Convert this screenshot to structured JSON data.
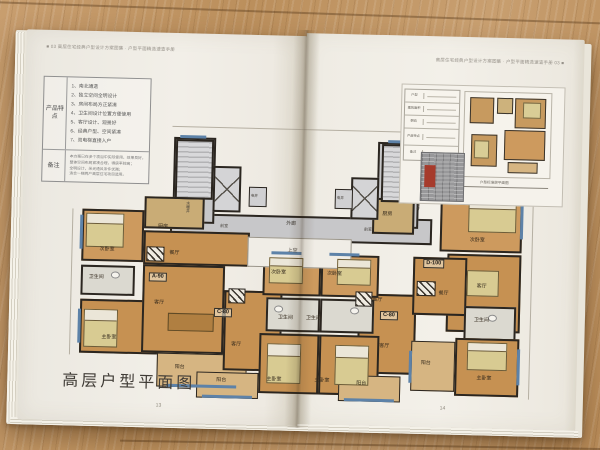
{
  "book": {
    "left_page": {
      "header": "■ 03 高层住宅经典户型设计方案图集 · 户型平面精选速查手册",
      "features": {
        "label": "产品特点",
        "items": [
          "1、南北通透",
          "2、独立空间全明设计",
          "3、房间布局方正紧凑",
          "4、卫生间设计位置方便使用",
          "5、客厅设计、观景好",
          "6、经典户型、空间紧凑",
          "7、双电梯直接入户"
        ]
      },
      "notes": {
        "label": "备注",
        "lines": [
          "本方案已在多个项目中实际使用，效果良好，",
          "整体空间布局紧凑合理，得房率较高；",
          "全明设计，采光通风条件优越；",
          "适合一梯两户高层住宅项目选用。"
        ]
      },
      "plan_title": "高层户型平面图",
      "page_number": "13"
    },
    "right_page": {
      "header": "高层住宅经典户型设计方案图集 · 户型平面精选速查手册 03 ■",
      "page_number": "14",
      "inset": {
        "rows": [
          "户型",
          "建筑面积",
          "朝向",
          "产品特点",
          "备注"
        ],
        "caption": "户型标准层平面图"
      }
    }
  },
  "plan": {
    "units": {
      "a90": "A-90",
      "c80": "C-80",
      "d100": "D-100"
    },
    "rooms": {
      "bedroom2": "次卧室",
      "master": "主卧室",
      "bath": "卫生间",
      "kitchen": "厨房",
      "dining": "餐厅",
      "living": "客厅",
      "balcony": "阳台",
      "lobby": "前室",
      "corridor": "外廊",
      "void": "上空",
      "elec_shaft": "电井",
      "plumb_shaft": "水暖井"
    }
  },
  "colors": {
    "wood": "#bf9465",
    "paper": "#f1eee7",
    "room_tan": "#c69152",
    "common_gray": "#c7c7c9",
    "wall": "#2b2620",
    "window_blue": "#5d82a8",
    "stamp_red": "#a63b2c"
  }
}
